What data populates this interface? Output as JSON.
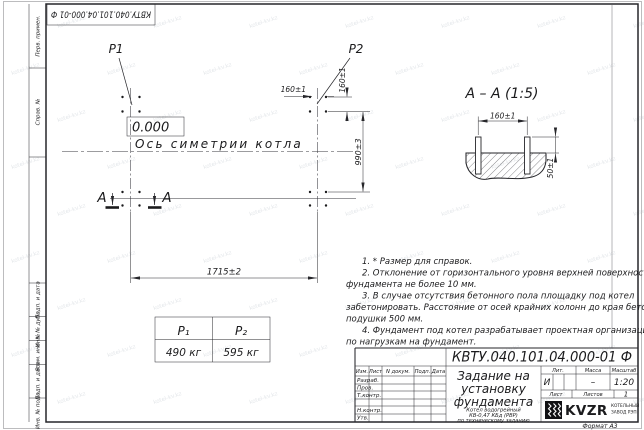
{
  "watermark": {
    "text": "kotel-kv.kz"
  },
  "frame": {
    "corner_stamp": "КВТУ.040.101.04.000-01  Ф",
    "format_note": "Формат А3",
    "margin_labels": [
      "Перв. примен.",
      "Справ. №",
      "Подп. и дата",
      "Инв. № дубл.",
      "Взам. инв. №",
      "Подп. и дата",
      "Инв. № подл."
    ]
  },
  "plan": {
    "p1_label": "P1",
    "p2_label": "P2",
    "elevation_mark": "0.000",
    "axis_label": "Ось симетрии котла",
    "section_letter_left": "А",
    "section_letter_right": "А",
    "dim_width": "1715±2",
    "dim_height": "990±3",
    "dim_bolt_h": "160±1",
    "dim_bolt_v": "160±1"
  },
  "section_view": {
    "title": "А – А (1:5)",
    "dim_bolt_spacing": "160±1",
    "dim_protrusion": "50±1"
  },
  "load_table": {
    "col1_header": "P₁",
    "col2_header": "P₂",
    "col1_value": "490 кг",
    "col2_value": "595 кг"
  },
  "notes": {
    "lines": [
      "1. * Размер для справок.",
      "2. Отклонение от горизонтального уровня верхней поверхности",
      "фундамента не более 10 мм.",
      "3. В случае отсутствия бетонного пола площадку под котел",
      "забетонировать. Расстояние от осей крайних колонн до края бетонной",
      "подушки 500 мм.",
      "4. Фундамент под котел разрабатывает проектная организация",
      "по нагрузкам на фундамент."
    ]
  },
  "title_block": {
    "doc_number": "КВТУ.040.101.04.000-01  Ф",
    "revision_headers": [
      "Изм.",
      "Лист",
      "N докум.",
      "Подп.",
      "Дата"
    ],
    "signature_rows": [
      "Разраб.",
      "Пров.",
      "Т.контр.",
      "",
      "Н.контр.",
      "Утв."
    ],
    "title_lines": [
      "Задание на",
      "установку",
      "фундамента"
    ],
    "subtitle_lines": [
      "Котел водогрейный",
      "КВ-0,47 КБд (РВР)",
      "по техническому заданию"
    ],
    "lit_header": "Лит.",
    "mass_header": "Масса",
    "scale_header": "Масштаб",
    "lit_value": "И",
    "mass_value": "–",
    "scale_value": "1:20",
    "sheet_label": "Лист",
    "sheets_label": "Листов",
    "sheets_value": "1",
    "company_logo": "KVZR",
    "company_caption": [
      "КОТЕЛЬНЫЙ",
      "ЗАВОД РЭП"
    ]
  }
}
